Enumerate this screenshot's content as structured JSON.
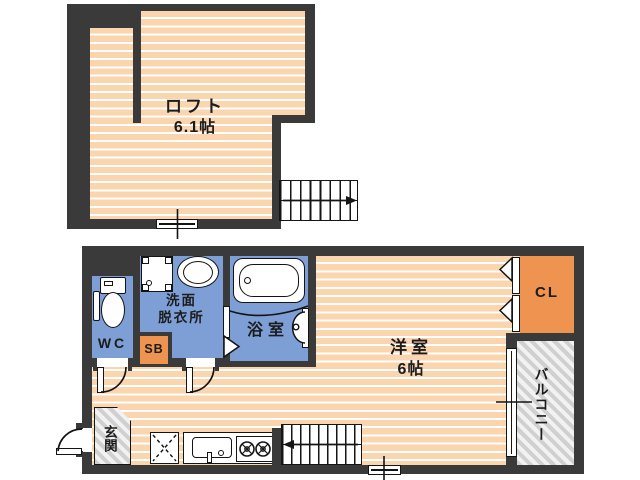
{
  "loft": {
    "room_label": "ロフト",
    "area_label": "6.1帖"
  },
  "floor1": {
    "wc_label": "WC",
    "washroom_label": "洗面\n脱衣所",
    "shoebox_label": "SB",
    "bath_label": "浴室",
    "main_room_label": "洋室",
    "main_room_area": "6帖",
    "closet_label": "CL",
    "balcony_label": "バルコニー",
    "entrance_label": "玄関"
  },
  "colors": {
    "wall": "#3a3a3a",
    "floor_base": "#fbd5ae",
    "floor_stripe": "#ffffff",
    "wet_room_blue": "#7d9fd6",
    "accent_orange": "#ee9350",
    "hatch_gray": "#d0d0d0",
    "outline": "#141414",
    "background": "#ffffff"
  }
}
